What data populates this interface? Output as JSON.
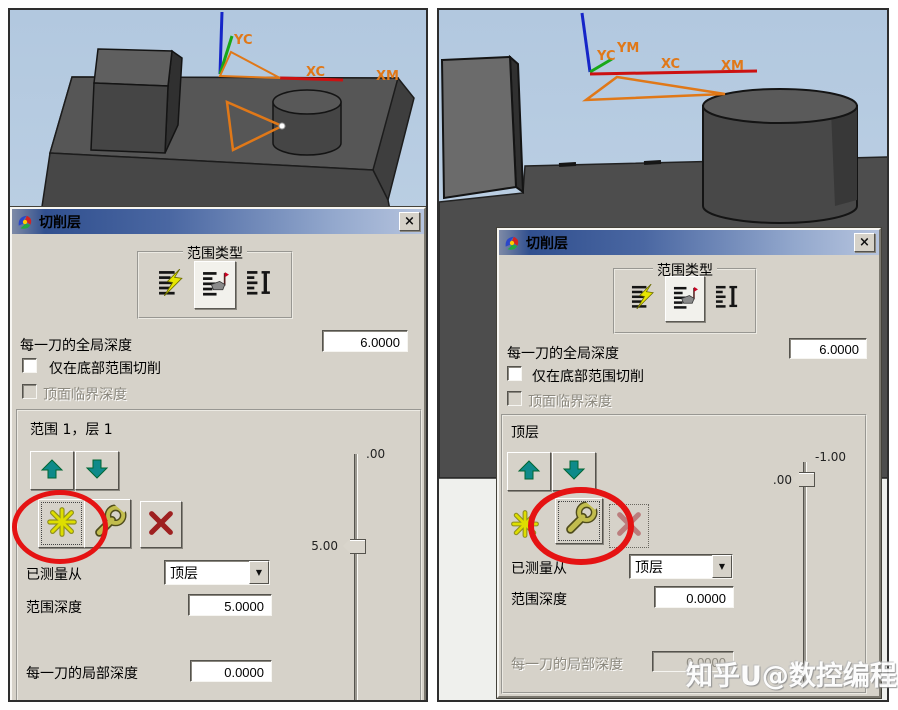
{
  "icons": {
    "dropdown_arrow": "▼",
    "close": "×"
  },
  "watermark": {
    "text": "知乎U@数控编程"
  },
  "panels": {
    "left": {
      "viewport": {
        "axis_y_label": "YC",
        "axis_x_label": "XC",
        "axis_xm_label": "XM"
      },
      "dialog": {
        "title": "切削层",
        "range_type": {
          "label": "范围类型"
        },
        "global_depth_label": "每一刀的全局深度",
        "global_depth_value": "6.0000",
        "bottom_only_label": "仅在底部范围切削",
        "top_critical_label": "顶面临界深度",
        "range_label": "范围 1，层 1",
        "measured_from_label": "已测量从",
        "measured_from_value": "顶层",
        "range_depth_label": "范围深度",
        "range_depth_value": "5.0000",
        "local_depth_label": "每一刀的局部深度",
        "local_depth_value": "0.0000",
        "slider": {
          "top_label": ".00",
          "thumb_label": "5.00"
        }
      }
    },
    "right": {
      "viewport": {
        "axis_y_label": "YC",
        "axis_ym_label": "YM",
        "axis_x_label": "XC",
        "axis_xm_label": "XM"
      },
      "dialog": {
        "title": "切削层",
        "range_type": {
          "label": "范围类型"
        },
        "global_depth_label": "每一刀的全局深度",
        "global_depth_value": "6.0000",
        "bottom_only_label": "仅在底部范围切削",
        "top_critical_label": "顶面临界深度",
        "range_label": "顶层",
        "measured_from_label": "已测量从",
        "measured_from_value": "顶层",
        "range_depth_label": "范围深度",
        "range_depth_value": "0.0000",
        "local_depth_label": "每一刀的局部深度",
        "local_depth_value": "0.0000",
        "slider": {
          "top_label": "-1.00",
          "thumb_label": ".00"
        }
      }
    }
  }
}
